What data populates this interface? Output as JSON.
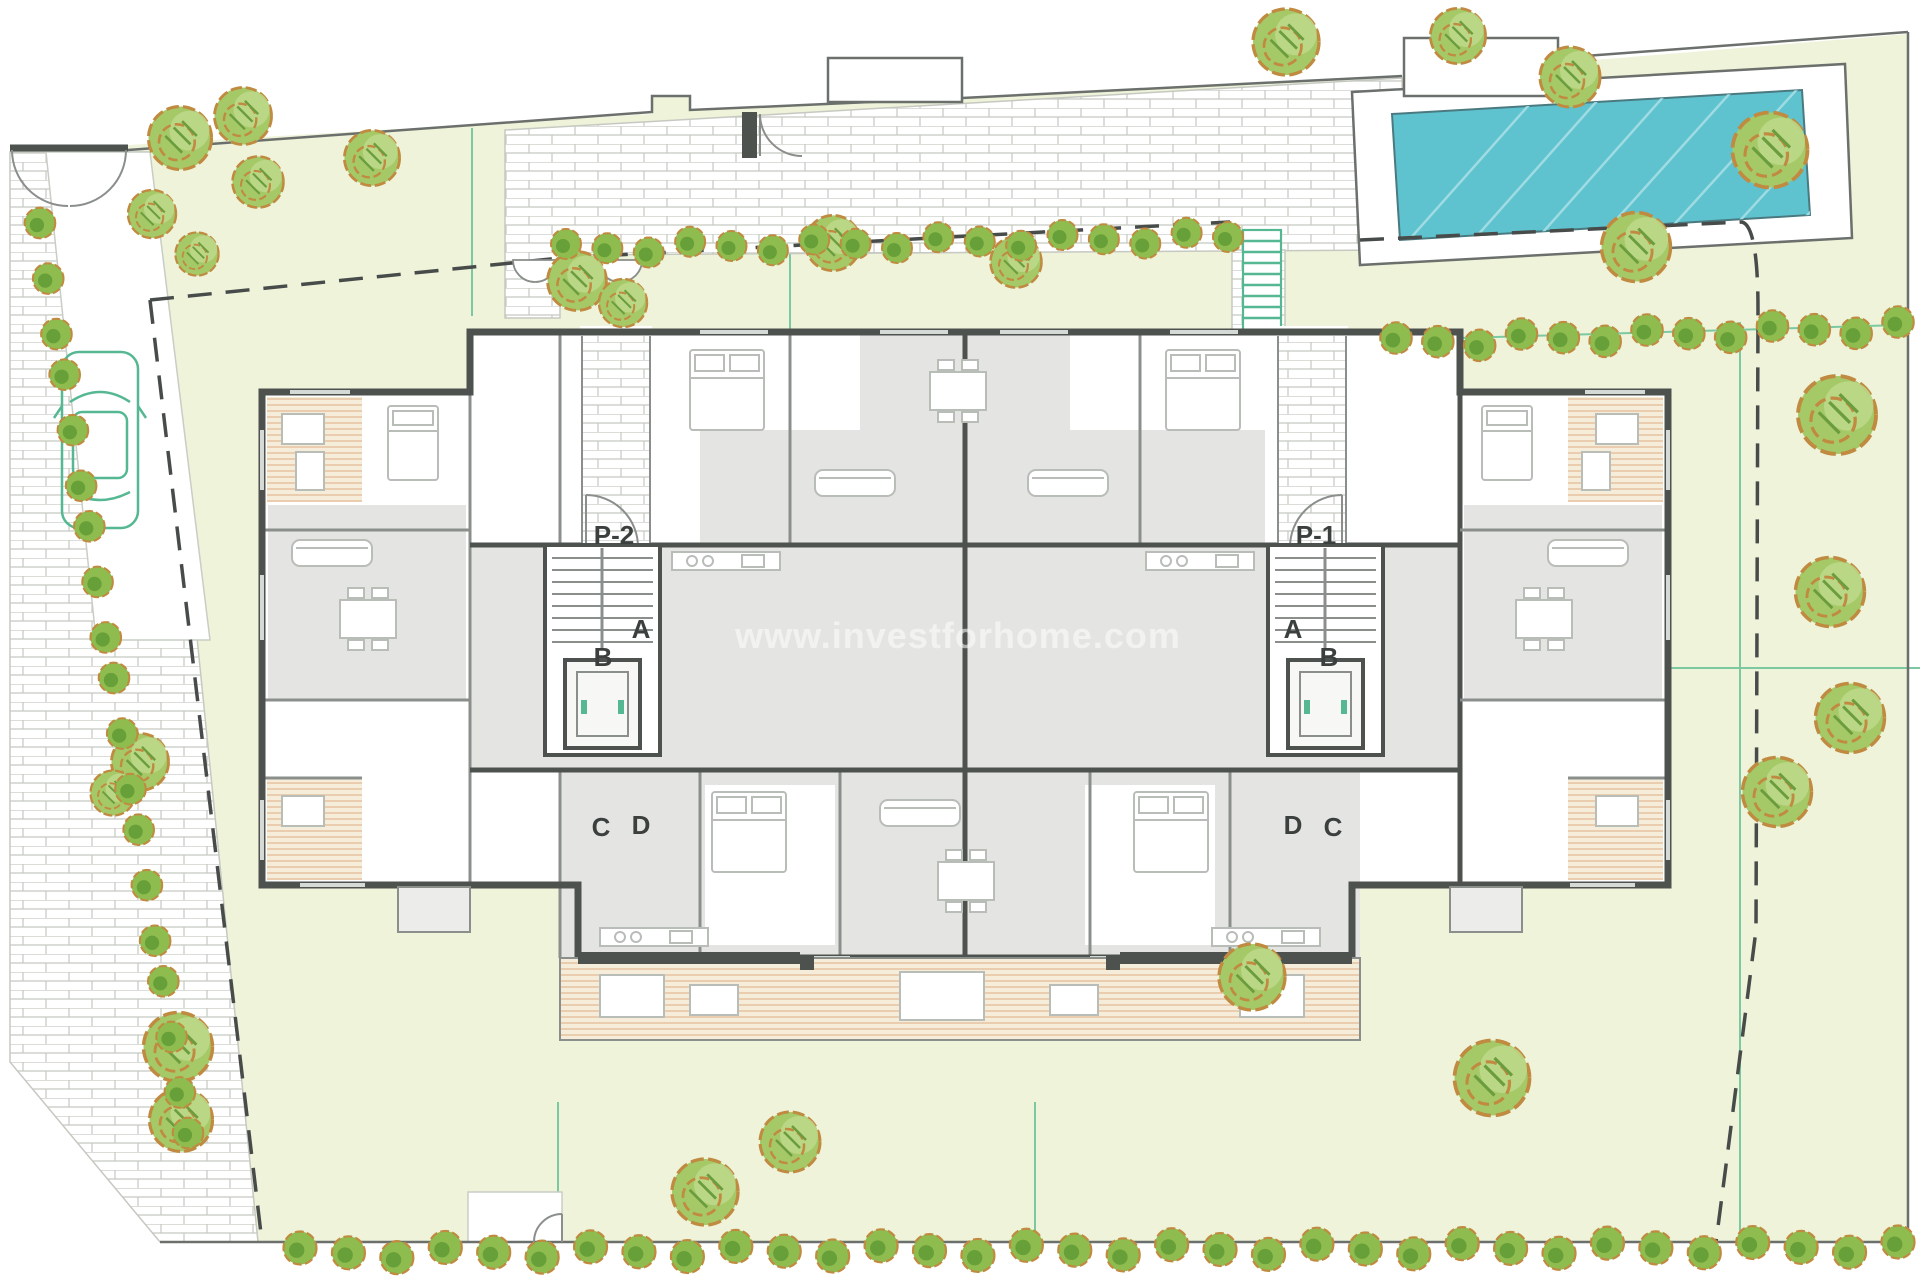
{
  "plan": {
    "watermark": "www.investforhome.com",
    "labels": {
      "p1": "P-1",
      "p2": "P-2",
      "a": "A",
      "b": "B",
      "c": "C",
      "d": "D"
    },
    "colors": {
      "garden": "#eef3da",
      "brickLine": "#c6c9c1",
      "boundary": "#6b706d",
      "dashLine": "#474c4a",
      "gridGreen": "#7cc9a1",
      "wall": "#4d524f",
      "innerWall": "#8a8f8b",
      "roomFill": "#ffffff",
      "commonFill": "#e4e4e2",
      "balconyFill": "#ececeb",
      "deckFill": "#f6ecda",
      "deckLine": "#dcae81",
      "pool": "#5ec3cf",
      "poolEdge": "#4a7a80",
      "poolHatch": "#9fdbe2",
      "treeFill": "#a6c968",
      "treeLight": "#bcd98a",
      "treeHatch": "#6b9c3e",
      "treeOutline": "#c08a40",
      "bushFill": "#8fbc4e",
      "bushCore": "#679f39",
      "carGreen": "#55b893",
      "furnitureStroke": "#b9bdb8",
      "labelColor": "#3b403e",
      "watermark": "#ffffff"
    }
  }
}
